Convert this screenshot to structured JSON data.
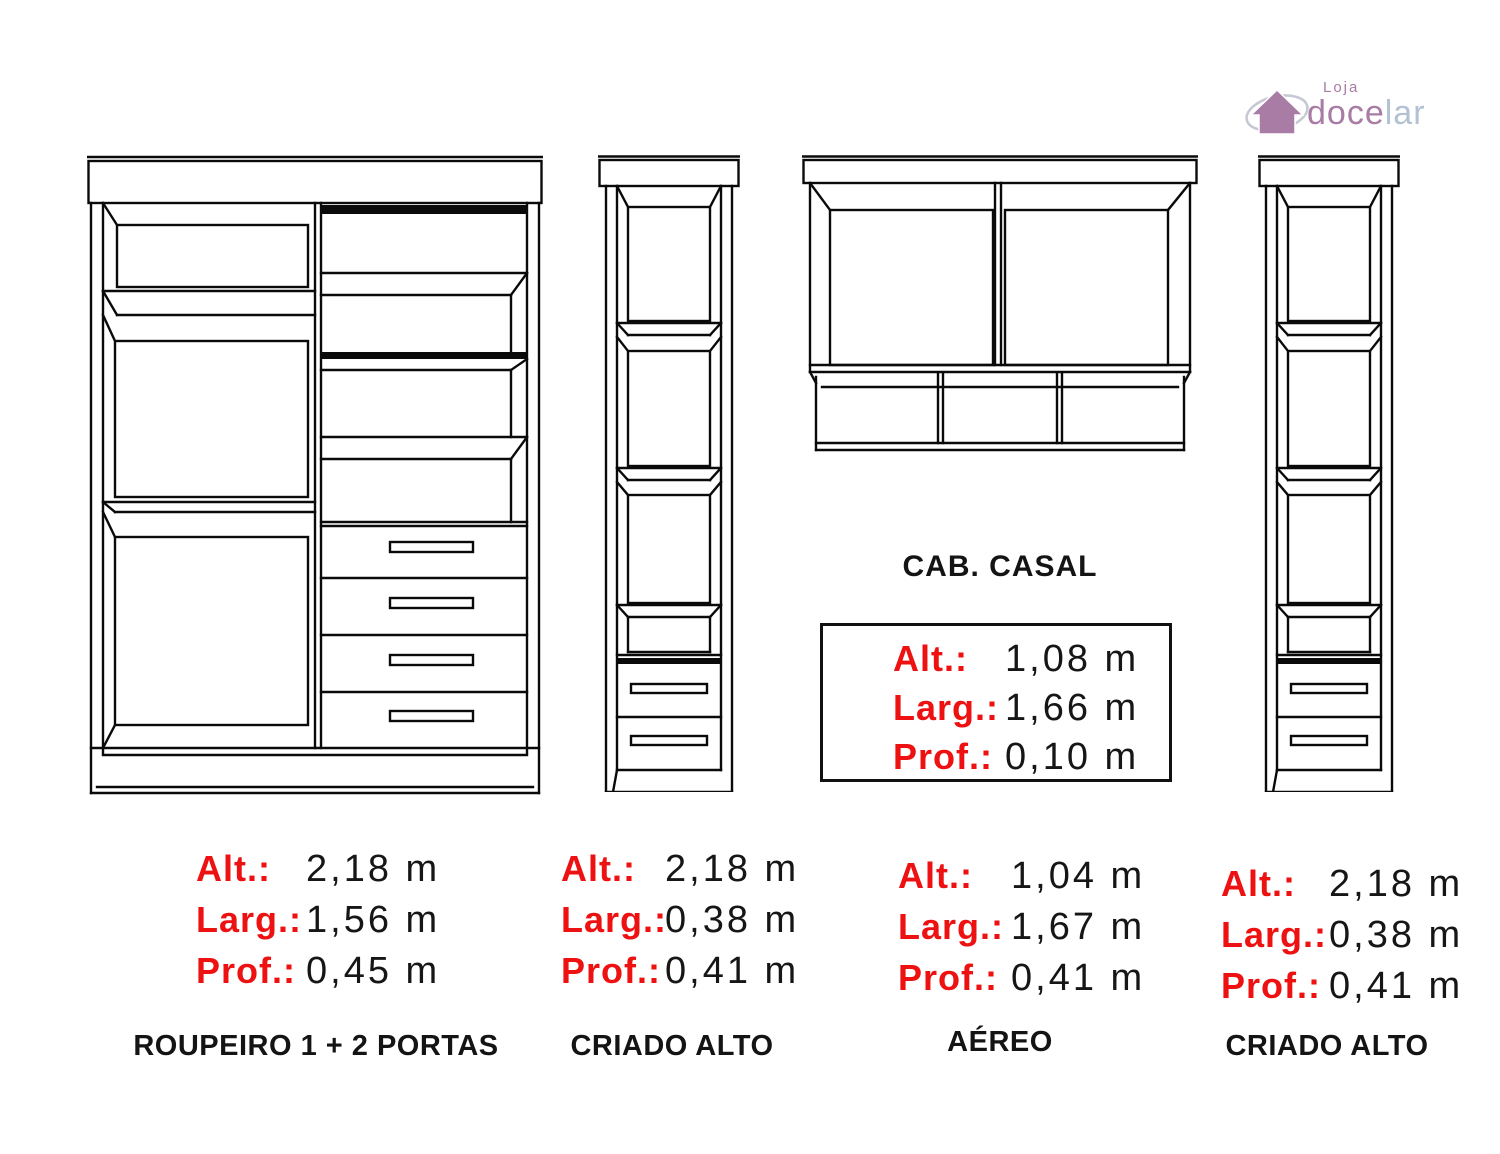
{
  "logo": {
    "top_text": "Loja",
    "name_part1": "doce",
    "name_part2": "lar",
    "color_purple": "#a87ca4",
    "color_blue": "#b3c2d3",
    "ellipse_color": "#c6c9d4"
  },
  "colors": {
    "label_red": "#ee1111",
    "value_black": "#161616",
    "line_black": "#0a0a0a",
    "background": "#ffffff"
  },
  "dim_labels": {
    "alt": "Alt.:",
    "larg": "Larg.:",
    "prof": "Prof.:"
  },
  "cab_casal": {
    "title": "CAB. CASAL",
    "alt": "1,08 m",
    "larg": "1,66 m",
    "prof": "0,10 m"
  },
  "furniture": [
    {
      "caption": "ROUPEIRO 1 + 2 PORTAS",
      "alt": "2,18 m",
      "larg": "1,56 m",
      "prof": "0,45 m"
    },
    {
      "caption": "CRIADO ALTO",
      "alt": "2,18 m",
      "larg": "0,38 m",
      "prof": "0,41 m"
    },
    {
      "caption": "AÉREO",
      "alt": "1,04 m",
      "larg": "1,67 m",
      "prof": "0,41 m"
    },
    {
      "caption": "CRIADO ALTO",
      "alt": "2,18 m",
      "larg": "0,38 m",
      "prof": "0,41 m"
    }
  ]
}
